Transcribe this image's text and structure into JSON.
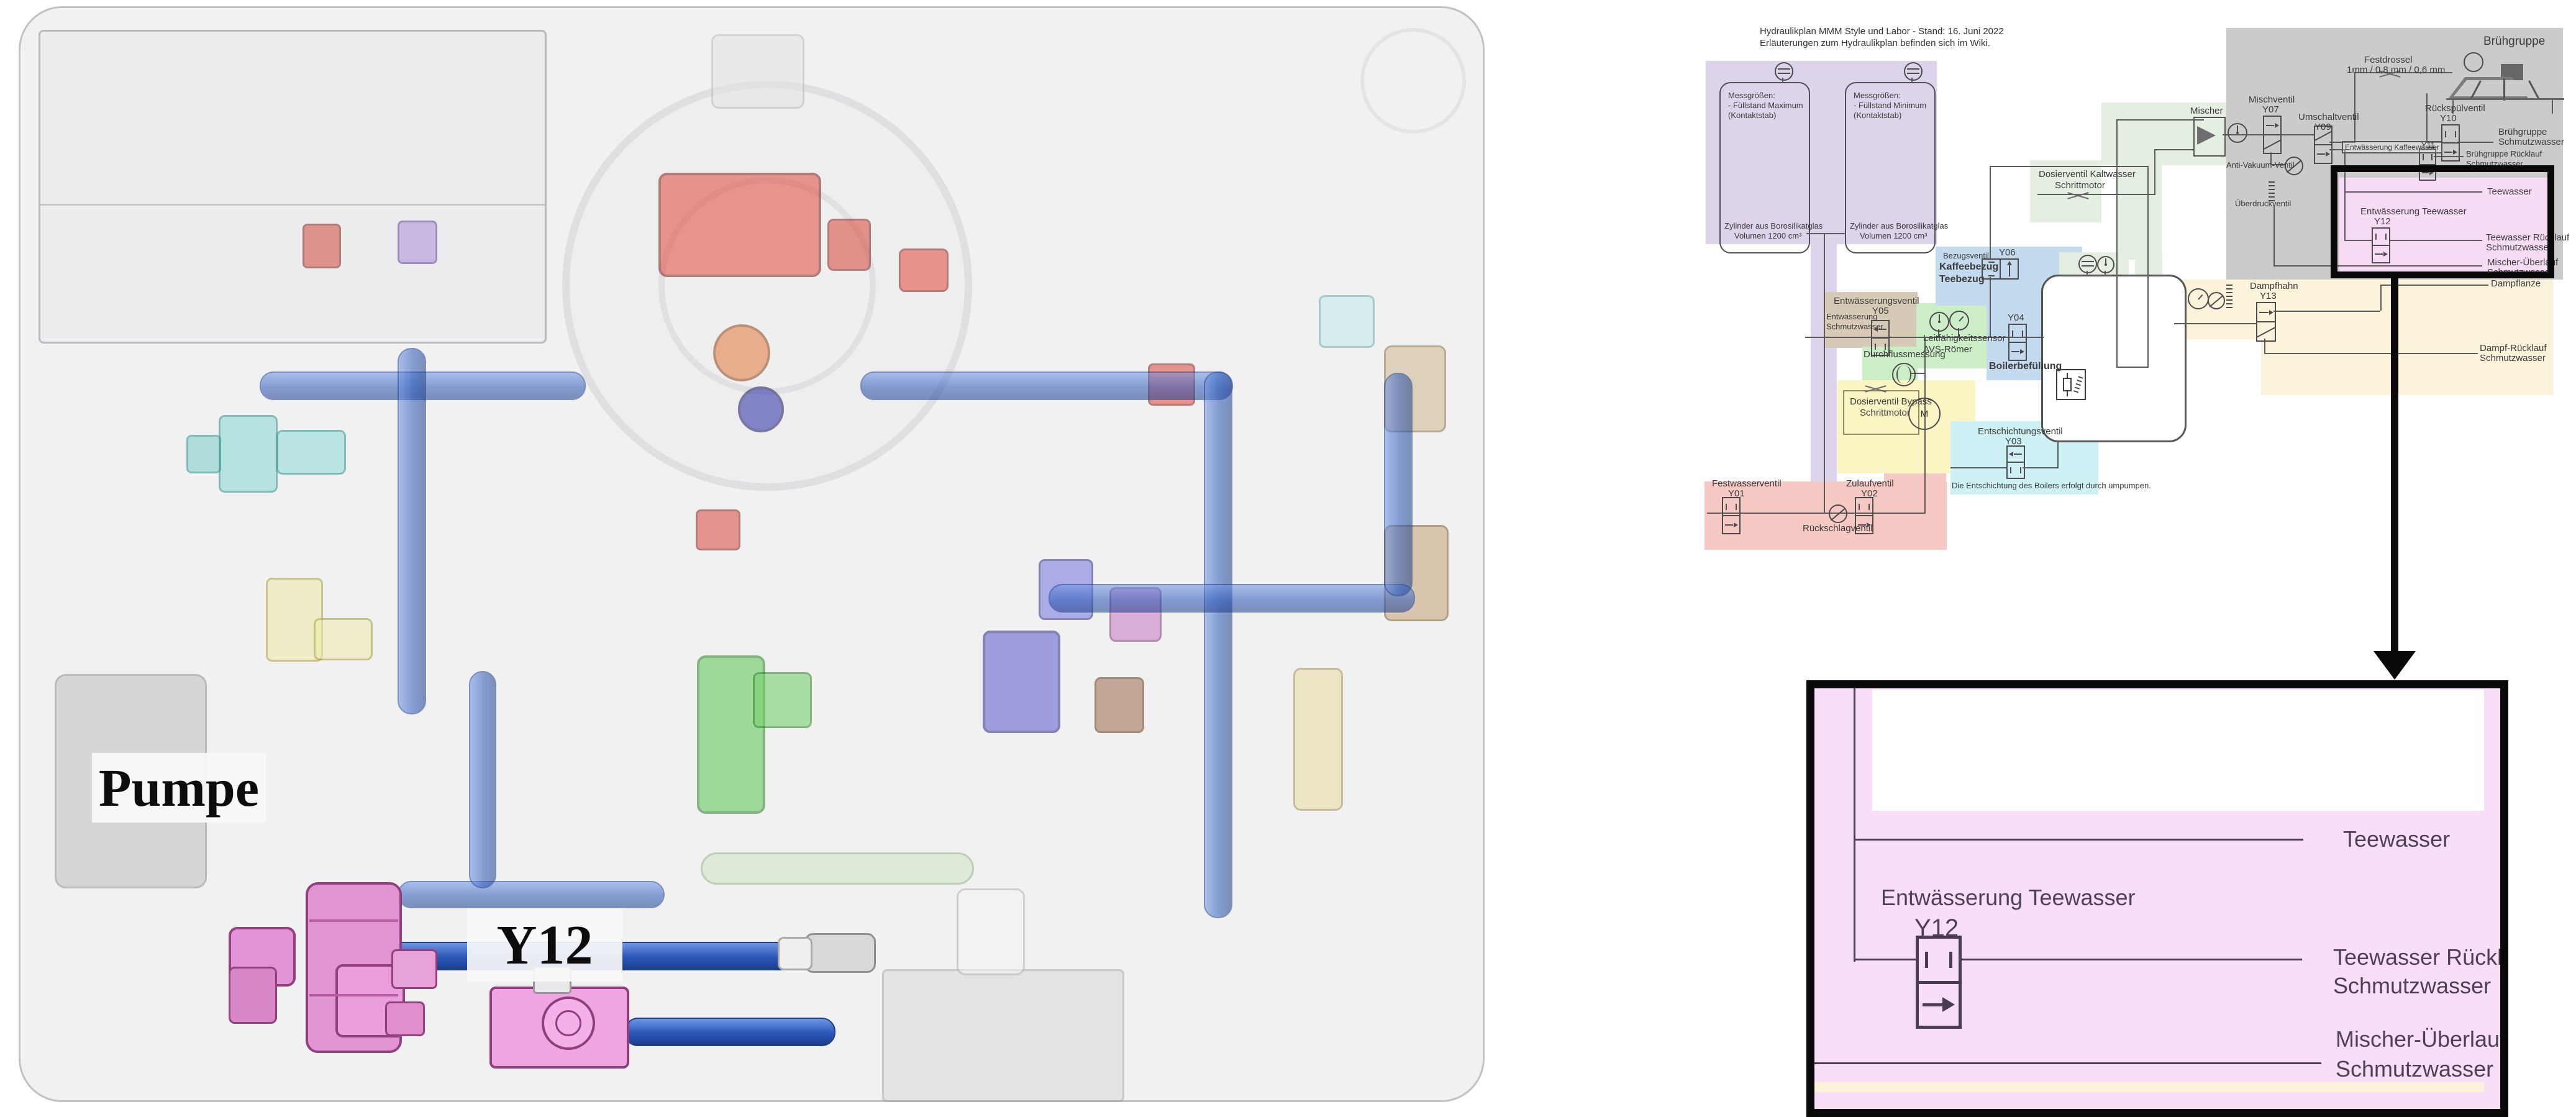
{
  "colors": {
    "purple_region": "#ddd3ea",
    "red_region": "#f6c9c4",
    "tan_region": "#d6c9b6",
    "green_region": "#cceec6",
    "pale_green_region": "#e4efe2",
    "yellow_region": "#fbf5c3",
    "blue_region": "#c4daee",
    "cyan_region": "#cdf1f5",
    "gray_region": "#cbcbcb",
    "pink_region": "#f8dcf6",
    "cream_region": "#fbf2da",
    "schematic_line": "#5b5b5b",
    "highlight_border": "#0a0a0a",
    "detail_text": "#4e4157",
    "machine_pink": "#ef9fe2",
    "tube_blue": "#2a57b8"
  },
  "machine_view": {
    "pump_label": "Pumpe",
    "valve_label": "Y12"
  },
  "schematic": {
    "title1": "Hydraulikplan MMM Style und Labor - Stand: 16. Juni 2022",
    "title2": "Erläuterungen zum Hydraulikplan befinden sich im Wiki.",
    "tank_left": {
      "l1": "Messgrößen:",
      "l2": "- Füllstand Maximum",
      "l3": "(Kontaktstab)",
      "l4": "Zylinder aus Borosilikatglas",
      "l5": "Volumen 1200 cm³"
    },
    "tank_right": {
      "l1": "Messgrößen:",
      "l2": "- Füllstand Minimum",
      "l3": "(Kontaktstab)",
      "l4": "Zylinder aus Borosilikatglas",
      "l5": "Volumen 1200 cm³"
    },
    "y01": {
      "label": "Festwasserventil",
      "id": "Y01"
    },
    "check_valve": "Rückschlagventil",
    "y02": {
      "label": "Zulaufventil",
      "id": "Y02"
    },
    "y05": {
      "label": "Entwässerungsventil",
      "id": "Y05",
      "out1": "Entwässerung",
      "out2": "Schmutzwasser"
    },
    "flow_meter": "Durchflussmessung",
    "conductivity": {
      "l1": "Leitfähigkeitssensor",
      "l2": "AVS-Römer"
    },
    "bypass": {
      "l1": "Dosierventil Bypass",
      "l2": "Schrittmotor"
    },
    "motor": "M",
    "y06": {
      "l1": "Bezugsventil",
      "l2": "Kaffeebezug",
      "l3": "Teebezug",
      "id": "Y06"
    },
    "y04": {
      "id": "Y04",
      "label": "Boilerbefüllung"
    },
    "y03": {
      "label": "Entschichtungsventil",
      "id": "Y03",
      "note": "Die Entschichtung des Boilers erfolgt durch umpumpen."
    },
    "cold": {
      "l1": "Dosierventil Kaltwasser",
      "l2": "Schrittmotor"
    },
    "mixer": "Mischer",
    "y07": {
      "label": "Mischventil",
      "id": "Y07"
    },
    "y09": {
      "label": "Umschaltventil",
      "id": "Y09"
    },
    "anti_vacuum": "Anti-Vakuum-Ventil",
    "overpressure": "Überdruckventil",
    "drossel": {
      "l1": "Festdrossel",
      "l2": "1mm / 0,8 mm / 0,6 mm"
    },
    "brew_group": "Brühgruppe",
    "y10": {
      "label": "Rückspülventil",
      "id": "Y10",
      "out1": "Brühgruppe",
      "out2": "Schmutzwasser"
    },
    "y11": {
      "label": "Entwässerung Kaffeewasser",
      "id": "Y11",
      "out1": "Brühgruppe Rücklauf",
      "out2": "Schmutzwasser"
    },
    "tea": {
      "supply": "Teewasser",
      "drain": "Entwässerung Teewasser",
      "id": "Y12",
      "ret1": "Teewasser Rücklauf",
      "ret2": "Schmutzwasser",
      "ovf1": "Mischer-Überlauf",
      "ovf2": "Schmutzwasser"
    },
    "steam": {
      "tap": "Dampfhahn",
      "id": "Y13",
      "lance": "Dampflanze",
      "ret1": "Dampf-Rücklauf",
      "ret2": "Schmutzwasser"
    }
  },
  "detail_view": {
    "supply": "Teewasser",
    "drain": "Entwässerung Teewasser",
    "id": "Y12",
    "ret1": "Teewasser Rücklauf",
    "ret2": "Schmutzwasser",
    "ovf1": "Mischer-Überlauf",
    "ovf2": "Schmutzwasser"
  }
}
